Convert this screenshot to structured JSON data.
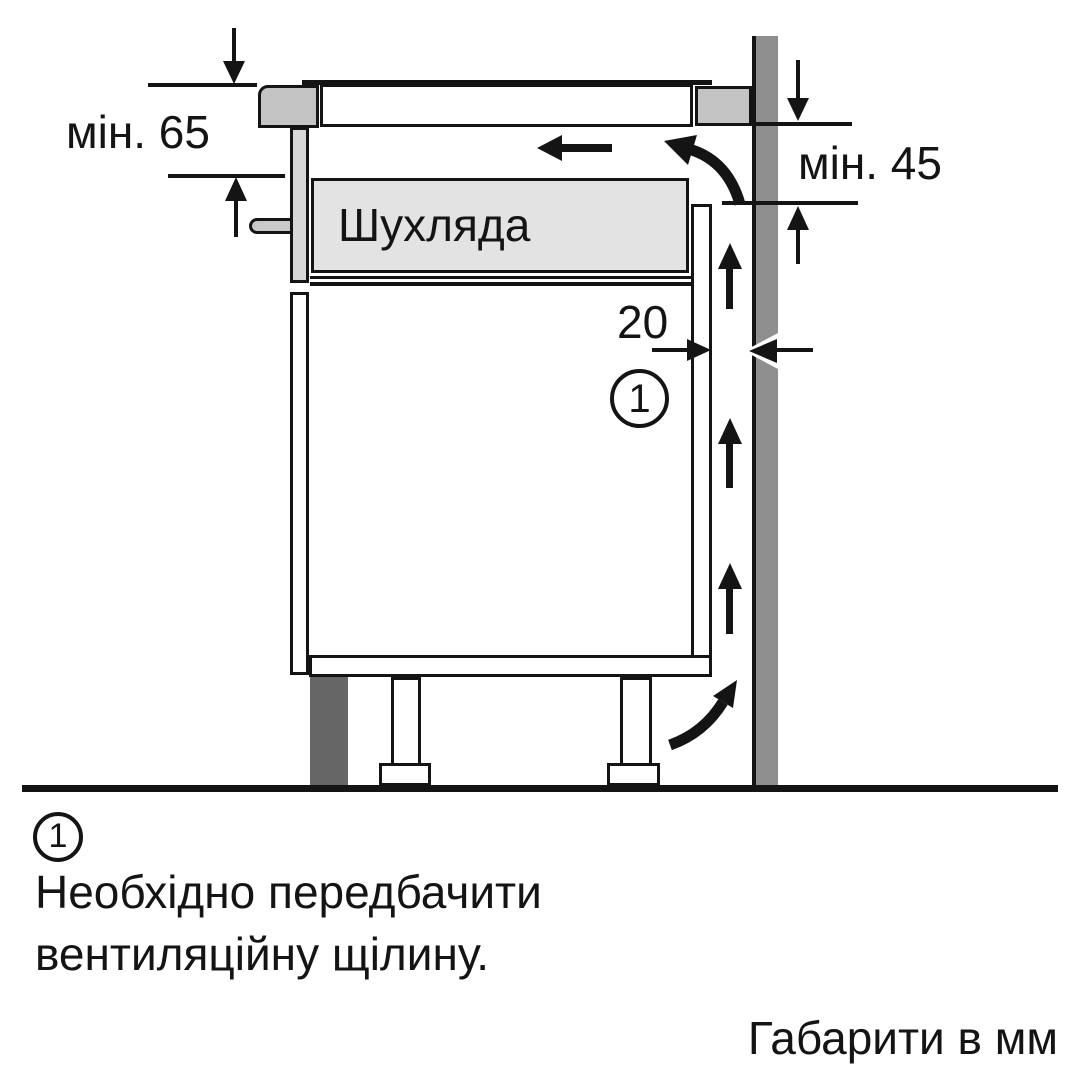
{
  "diagram": {
    "drawer_label": "Шухляда",
    "dim_min_left": "мін. 65",
    "dim_min_right": "мін. 45",
    "dim_gap_mm": "20",
    "callout_number": "1"
  },
  "legend": {
    "callout_number": "1",
    "note_line1": "Необхідно передбачити",
    "note_line2": "вентиляційну щілину.",
    "units_note": "Габарити в мм"
  },
  "colors": {
    "line_black": "#141414",
    "wall_gray": "#8f8f8f",
    "plinth_dark_gray": "#666666",
    "worktop_end_gray": "#c3c3c3",
    "housing_strip_gray": "#d7d7d7",
    "drawer_fill_gray": "#e3e3e3",
    "fixing_peg_gray": "#c9c9c9",
    "background": "#ffffff"
  }
}
